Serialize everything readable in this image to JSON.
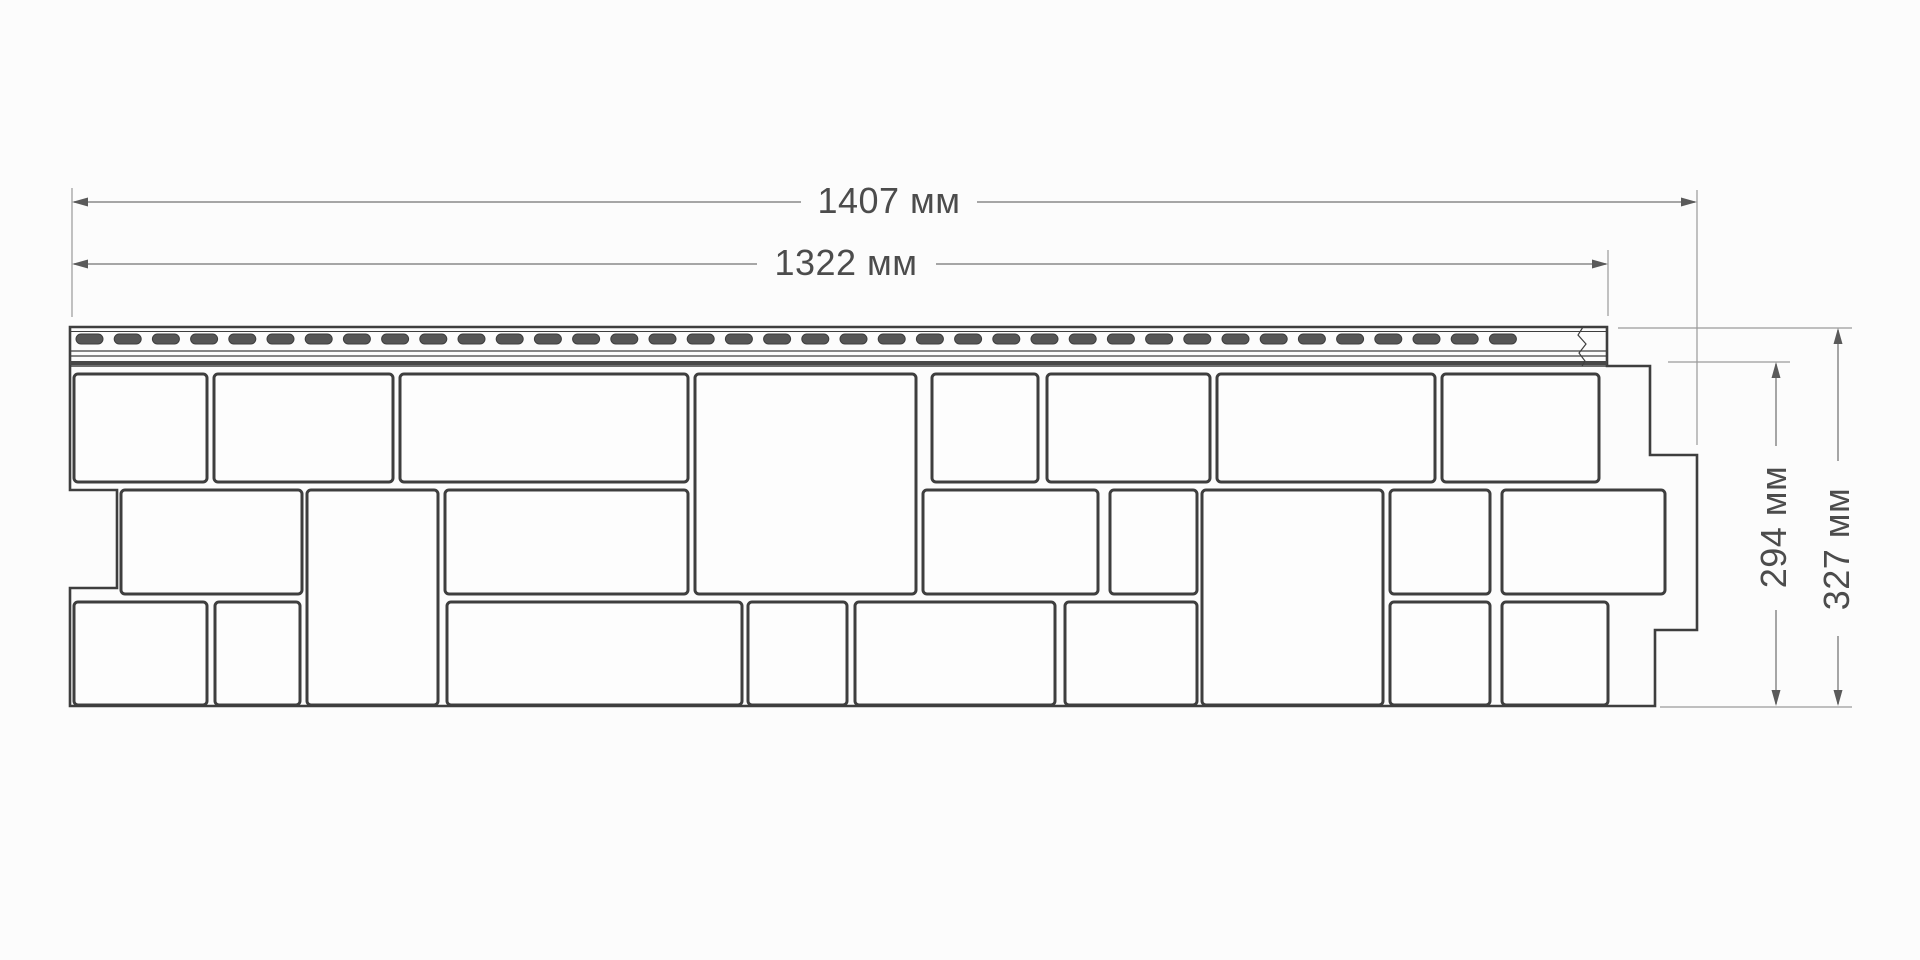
{
  "diagram": {
    "labels": {
      "width_overall": "1407 мм",
      "width_visible": "1322 мм",
      "height_visible": "294 мм",
      "height_overall": "327 мм"
    },
    "colors": {
      "background": "#fcfcfc",
      "outline": "#3e3e3e",
      "stone_fill": "#fdfdfd",
      "slot_fill": "#565656",
      "hem_band": "#484848",
      "dim_line": "#8a8a8a",
      "ext_line": "#9a9a9a",
      "arrow": "#5a5a5a"
    },
    "panel": {
      "outline": [
        [
          70,
          327
        ],
        [
          1607,
          327
        ],
        [
          1607,
          366
        ],
        [
          1650,
          366
        ],
        [
          1650,
          455
        ],
        [
          1697,
          455
        ],
        [
          1697,
          630
        ],
        [
          1655,
          630
        ],
        [
          1655,
          706
        ],
        [
          70,
          706
        ],
        [
          70,
          588
        ],
        [
          117,
          588
        ],
        [
          117,
          490
        ],
        [
          70,
          490
        ]
      ],
      "hem": {
        "x1": 70,
        "x2": 1607,
        "top": 327,
        "inner_top": 331.5,
        "line1": 351,
        "line2": 356,
        "band_top": 361,
        "band_h": 4,
        "bottom": 366,
        "slot_y": 334,
        "slot_h": 10,
        "slot_w": 27,
        "slot_start": 76,
        "slot_pitch": 38.2,
        "slot_end": 1530,
        "break_x": 1583
      },
      "stones": [
        [
          74,
          374,
          133,
          108
        ],
        [
          214,
          374,
          179,
          108
        ],
        [
          400,
          374,
          288,
          108
        ],
        [
          695,
          374,
          221,
          220
        ],
        [
          932,
          374,
          106,
          108
        ],
        [
          1047,
          374,
          163,
          108
        ],
        [
          1217,
          374,
          218,
          108
        ],
        [
          1442,
          374,
          157,
          108
        ],
        [
          121,
          490,
          181,
          104
        ],
        [
          307,
          490,
          131,
          215
        ],
        [
          445,
          490,
          243,
          104
        ],
        [
          923,
          490,
          175,
          104
        ],
        [
          1110,
          490,
          87,
          104
        ],
        [
          1202,
          490,
          181,
          215
        ],
        [
          1390,
          490,
          100,
          104
        ],
        [
          1502,
          490,
          163,
          104
        ],
        [
          74,
          602,
          133,
          103
        ],
        [
          215,
          602,
          85,
          103
        ],
        [
          447,
          602,
          295,
          103
        ],
        [
          748,
          602,
          99,
          103
        ],
        [
          855,
          602,
          200,
          103
        ],
        [
          1065,
          602,
          132,
          103
        ],
        [
          1390,
          602,
          100,
          103
        ],
        [
          1502,
          602,
          106,
          103
        ]
      ]
    },
    "dimensions": {
      "horizontal": [
        {
          "label_key": "width_overall",
          "y": 202,
          "tip1": 72,
          "tip2": 1697,
          "segments": [
            [
              74,
              801
            ],
            [
              977,
              1695
            ]
          ],
          "ext": [
            {
              "x": 72,
              "y1": 188,
              "y2": 317
            },
            {
              "x": 1697,
              "y1": 190,
              "y2": 445
            }
          ]
        },
        {
          "label_key": "width_visible",
          "y": 264,
          "tip1": 72,
          "tip2": 1608,
          "segments": [
            [
              74,
              757
            ],
            [
              936,
              1606
            ]
          ],
          "ext": [
            {
              "x": 1608,
              "y1": 250,
              "y2": 316
            }
          ]
        }
      ],
      "vertical": [
        {
          "label_key": "height_visible",
          "x": 1776,
          "tip1": 362,
          "tip2": 706,
          "segments": [
            [
              364,
              446
            ],
            [
              610,
              704
            ]
          ],
          "ext": [
            {
              "y": 362,
              "x1": 1668,
              "x2": 1790
            }
          ]
        },
        {
          "label_key": "height_overall",
          "x": 1838,
          "tip1": 328,
          "tip2": 706,
          "segments": [
            [
              330,
              461
            ],
            [
              636,
              704
            ]
          ],
          "ext": [
            {
              "y": 328,
              "x1": 1618,
              "x2": 1852
            },
            {
              "y": 707,
              "x1": 1660,
              "x2": 1852
            }
          ]
        }
      ]
    }
  }
}
